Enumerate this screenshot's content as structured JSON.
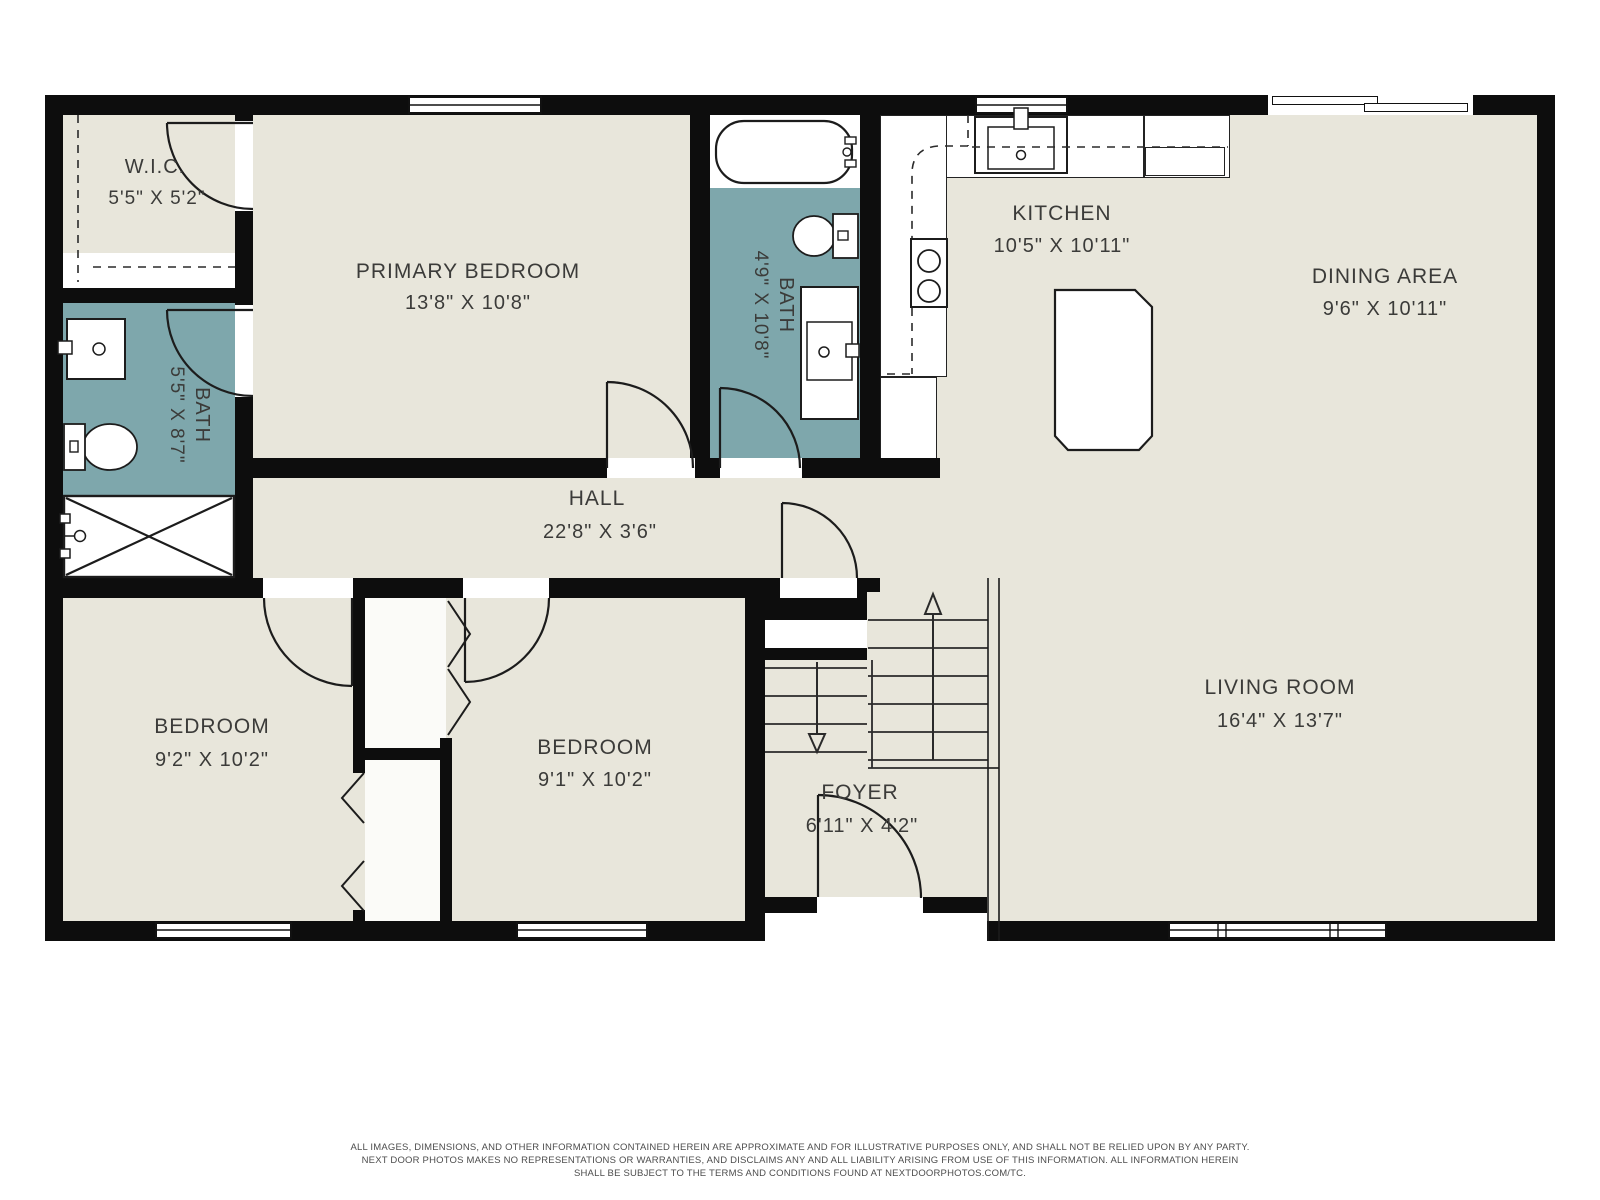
{
  "colors": {
    "floor": "#e8e6db",
    "bath_accent": "#7ea7ac",
    "wall": "#0d0d0d",
    "linework": "#1c1c1c",
    "text": "#3b3b39"
  },
  "rooms": {
    "wic": {
      "name": "W.I.C.",
      "dims": "5'5\" X 5'2\""
    },
    "primary_bedroom": {
      "name": "PRIMARY BEDROOM",
      "dims": "13'8\" X 10'8\""
    },
    "bath_primary": {
      "name": "BATH",
      "dims": "5'5\" X 8'7\""
    },
    "bath_hall": {
      "name": "BATH",
      "dims": "4'9\" X 10'8\""
    },
    "kitchen": {
      "name": "KITCHEN",
      "dims": "10'5\" X 10'11\""
    },
    "dining_area": {
      "name": "DINING AREA",
      "dims": "9'6\" X 10'11\""
    },
    "hall": {
      "name": "HALL",
      "dims": "22'8\" X 3'6\""
    },
    "bedroom_left": {
      "name": "BEDROOM",
      "dims": "9'2\" X 10'2\""
    },
    "bedroom_middle": {
      "name": "BEDROOM",
      "dims": "9'1\" X 10'2\""
    },
    "foyer": {
      "name": "FOYER",
      "dims": "6'11\" X 4'2\""
    },
    "living_room": {
      "name": "LIVING ROOM",
      "dims": "16'4\" X 13'7\""
    }
  },
  "disclaimer": {
    "line1": "ALL IMAGES, DIMENSIONS, AND OTHER INFORMATION CONTAINED HEREIN ARE APPROXIMATE AND FOR ILLUSTRATIVE PURPOSES ONLY, AND SHALL NOT BE RELIED UPON BY ANY PARTY.",
    "line2": "NEXT DOOR PHOTOS MAKES NO REPRESENTATIONS OR WARRANTIES, AND DISCLAIMS ANY AND ALL LIABILITY ARISING FROM USE OF THIS INFORMATION. ALL INFORMATION HEREIN",
    "line3": "SHALL BE SUBJECT TO THE TERMS AND CONDITIONS FOUND AT NEXTDOORPHOTOS.COM/TC."
  }
}
